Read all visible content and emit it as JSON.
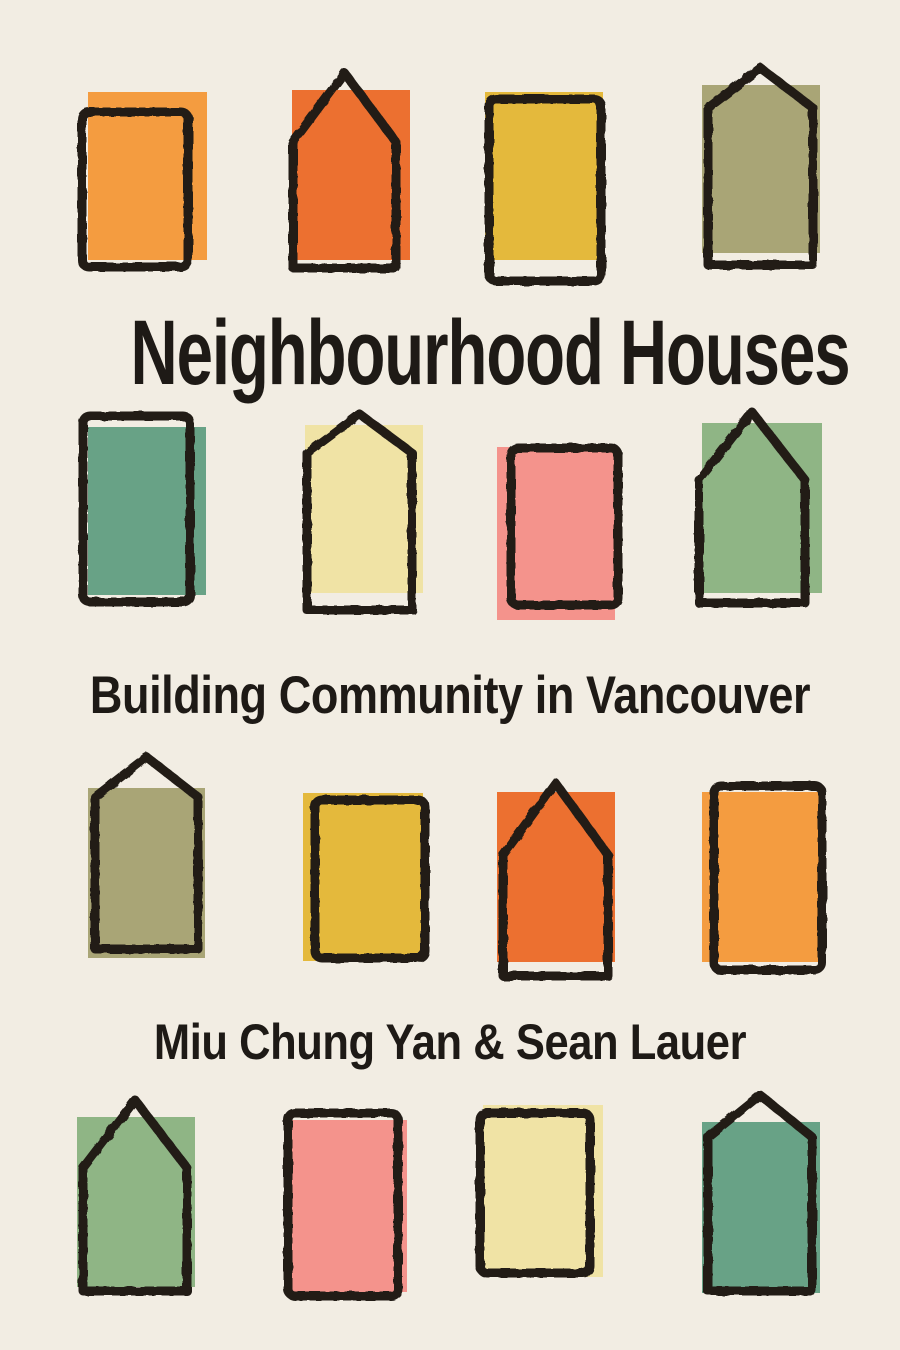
{
  "cover": {
    "title": "Neighbourhood Houses",
    "subtitle": "Building Community in Vancouver",
    "authors": "Miu Chung Yan & Sean Lauer",
    "background_color": "#f2ede3",
    "ink_color": "#201b15",
    "text_color": "#1e1a16"
  },
  "palette": {
    "orange_light": "#f49c40",
    "orange_dark": "#ec7030",
    "mustard": "#e4b93c",
    "olive": "#a9a576",
    "teal": "#68a286",
    "pale_yellow": "#f0e3a5",
    "pink": "#f4938c",
    "green": "#8fb585"
  },
  "houses": [
    {
      "row": 1,
      "col": 1,
      "color_name": "orange_light",
      "fill": {
        "x": 88,
        "y": 92,
        "w": 119,
        "h": 168
      },
      "outline": {
        "type": "rect",
        "x": 82,
        "y": 112,
        "w": 106,
        "h": 155
      }
    },
    {
      "row": 1,
      "col": 2,
      "color_name": "orange_dark",
      "fill": {
        "x": 292,
        "y": 90,
        "w": 118,
        "h": 170
      },
      "outline": {
        "type": "house",
        "left": 293,
        "right": 396,
        "top": 73,
        "eaves": 142,
        "bottom": 268
      }
    },
    {
      "row": 1,
      "col": 3,
      "color_name": "mustard",
      "fill": {
        "x": 485,
        "y": 92,
        "w": 118,
        "h": 168
      },
      "outline": {
        "type": "rect",
        "x": 489,
        "y": 99,
        "w": 112,
        "h": 182
      }
    },
    {
      "row": 1,
      "col": 4,
      "color_name": "olive",
      "fill": {
        "x": 702,
        "y": 85,
        "w": 118,
        "h": 168
      },
      "outline": {
        "type": "house",
        "left": 708,
        "right": 813,
        "top": 68,
        "eaves": 108,
        "bottom": 265
      }
    },
    {
      "row": 2,
      "col": 1,
      "color_name": "teal",
      "fill": {
        "x": 88,
        "y": 427,
        "w": 118,
        "h": 168
      },
      "outline": {
        "type": "rect",
        "x": 83,
        "y": 416,
        "w": 107,
        "h": 186
      }
    },
    {
      "row": 2,
      "col": 2,
      "color_name": "pale_yellow",
      "fill": {
        "x": 305,
        "y": 425,
        "w": 118,
        "h": 168
      },
      "outline": {
        "type": "house",
        "left": 307,
        "right": 412,
        "top": 414,
        "eaves": 453,
        "bottom": 610
      }
    },
    {
      "row": 2,
      "col": 3,
      "color_name": "pink",
      "fill": {
        "x": 497,
        "y": 447,
        "w": 118,
        "h": 173
      },
      "outline": {
        "type": "rect",
        "x": 511,
        "y": 448,
        "w": 107,
        "h": 157
      }
    },
    {
      "row": 2,
      "col": 4,
      "color_name": "green",
      "fill": {
        "x": 702,
        "y": 423,
        "w": 120,
        "h": 170
      },
      "outline": {
        "type": "house",
        "left": 699,
        "right": 805,
        "top": 412,
        "eaves": 480,
        "bottom": 603
      }
    },
    {
      "row": 3,
      "col": 1,
      "color_name": "olive",
      "fill": {
        "x": 88,
        "y": 788,
        "w": 117,
        "h": 170
      },
      "outline": {
        "type": "house",
        "left": 95,
        "right": 198,
        "top": 757,
        "eaves": 797,
        "bottom": 949
      }
    },
    {
      "row": 3,
      "col": 2,
      "color_name": "mustard",
      "fill": {
        "x": 303,
        "y": 793,
        "w": 120,
        "h": 168
      },
      "outline": {
        "type": "rect",
        "x": 315,
        "y": 800,
        "w": 110,
        "h": 158
      }
    },
    {
      "row": 3,
      "col": 3,
      "color_name": "orange_dark",
      "fill": {
        "x": 497,
        "y": 792,
        "w": 118,
        "h": 170
      },
      "outline": {
        "type": "house",
        "left": 503,
        "right": 608,
        "top": 783,
        "eaves": 855,
        "bottom": 976
      }
    },
    {
      "row": 3,
      "col": 4,
      "color_name": "orange_light",
      "fill": {
        "x": 702,
        "y": 792,
        "w": 118,
        "h": 170
      },
      "outline": {
        "type": "rect",
        "x": 714,
        "y": 786,
        "w": 108,
        "h": 184
      }
    },
    {
      "row": 4,
      "col": 1,
      "color_name": "green",
      "fill": {
        "x": 77,
        "y": 1117,
        "w": 118,
        "h": 170
      },
      "outline": {
        "type": "house",
        "left": 83,
        "right": 187,
        "top": 1100,
        "eaves": 1168,
        "bottom": 1291
      }
    },
    {
      "row": 4,
      "col": 2,
      "color_name": "pink",
      "fill": {
        "x": 290,
        "y": 1120,
        "w": 117,
        "h": 172
      },
      "outline": {
        "type": "rect",
        "x": 288,
        "y": 1113,
        "w": 110,
        "h": 183
      }
    },
    {
      "row": 4,
      "col": 3,
      "color_name": "pale_yellow",
      "fill": {
        "x": 483,
        "y": 1105,
        "w": 120,
        "h": 172
      },
      "outline": {
        "type": "rect",
        "x": 480,
        "y": 1113,
        "w": 110,
        "h": 160
      }
    },
    {
      "row": 4,
      "col": 4,
      "color_name": "teal",
      "fill": {
        "x": 702,
        "y": 1122,
        "w": 118,
        "h": 171
      },
      "outline": {
        "type": "house",
        "left": 708,
        "right": 812,
        "top": 1095,
        "eaves": 1137,
        "bottom": 1291
      }
    }
  ]
}
